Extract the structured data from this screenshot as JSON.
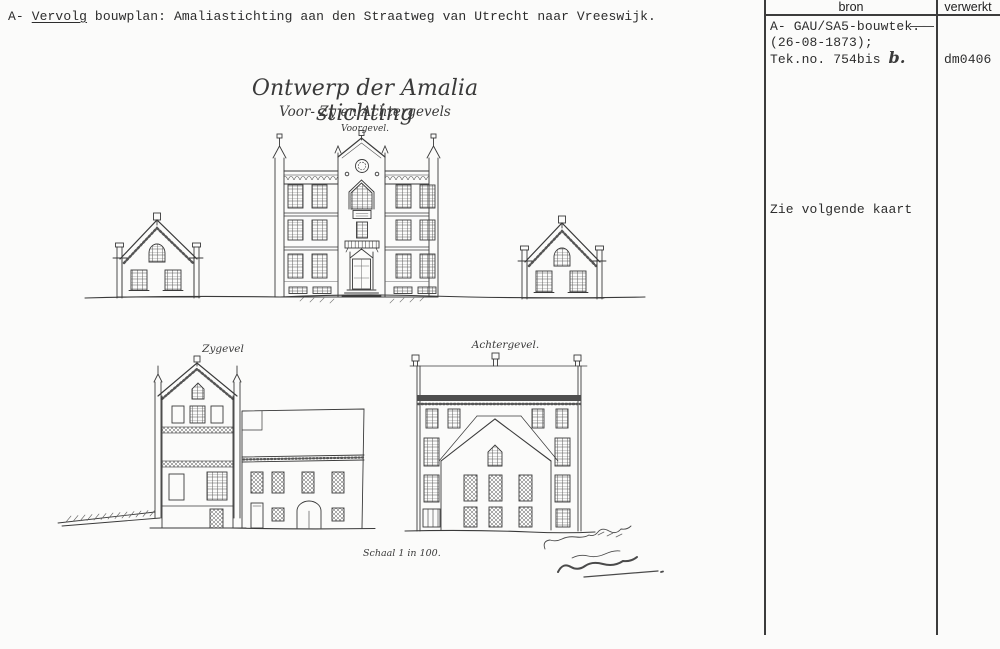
{
  "header": {
    "prefix": "A- ",
    "underlined_word": "Vervolg",
    "rest": " bouwplan: Amaliastichting aan den Straatweg van Utrecht naar Vreeswijk."
  },
  "drawing": {
    "title": "Ontwerp der Amalia stichting",
    "subtitle": "Voor- Zy en Achtergevels",
    "label_voorgevel": "Voorgevel.",
    "label_zygevel": "Zygevel",
    "label_achtergevel": "Achtergevel.",
    "label_schaal": "Schaal 1 in 100."
  },
  "table": {
    "columns": [
      "bron",
      "verwerkt"
    ],
    "entries": [
      {
        "bron_line1": "A- GAU/SA5-bouwtek.-",
        "bron_line2": "(26-08-1873);",
        "bron_line3": "Tek.no. 754bis",
        "bron_handwritten": "b.",
        "verwerkt": "dm0406"
      },
      {
        "bron_note": "Zie volgende kaart",
        "verwerkt": ""
      }
    ]
  },
  "colors": {
    "ink": "#3a3a3a",
    "paper": "#fbfbfa",
    "line": "#3c3c3c"
  }
}
